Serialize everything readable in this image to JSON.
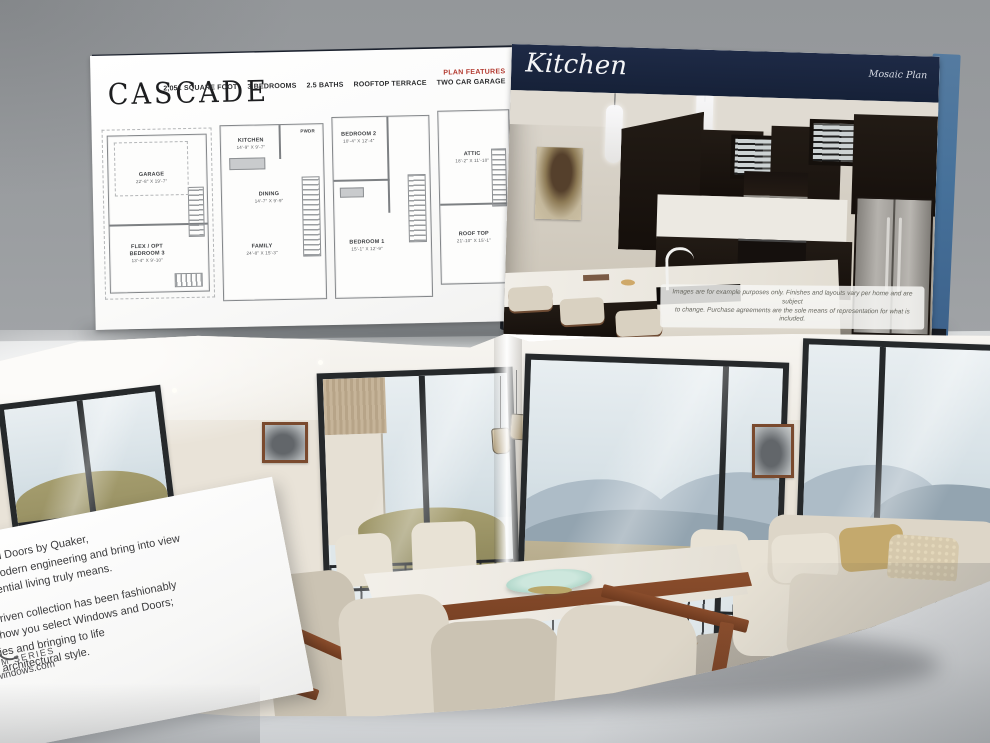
{
  "brochure_top": {
    "cascade_page": {
      "title": "CASCADE",
      "plan_features_label": "PLAN FEATURES",
      "stats": [
        "2,051 SQUARE FOOT",
        "3 BEDROOMS",
        "2.5 BATHS",
        "ROOFTOP TERRACE",
        "TWO CAR GARAGE"
      ],
      "floor_plans": {
        "main": {
          "garage_label": "GARAGE",
          "garage_dims": "22'-8\" X 19'-7\"",
          "flex_label": "FLEX / OPT BEDROOM 3",
          "flex_dims": "13'-4\" X 9'-10\""
        },
        "living": {
          "kitchen_label": "KITCHEN",
          "kitchen_dims": "14'-9\" X 9'-7\"",
          "pwdr_label": "PWDR",
          "dining_label": "DINING",
          "dining_dims": "14'-7\" X 9'-9\"",
          "family_label": "FAMILY",
          "family_dims": "24'-8\" X 15'-3\""
        },
        "bedroom": {
          "bed2_label": "BEDROOM 2",
          "bed2_dims": "10'-4\" X 12'-4\"",
          "bed1_label": "BEDROOM 1",
          "bed1_dims": "15'-1\" X 12'-9\""
        },
        "roof": {
          "attic_label": "ATTIC",
          "attic_dims": "18'-2\" X 11'-10\"",
          "rooftop_label": "ROOF TOP",
          "rooftop_dims": "21'-10\" X 15'-1\""
        }
      }
    },
    "kitchen_page": {
      "title": "Kitchen",
      "plan_name": "Mosaic Plan",
      "disclaimer_line1": "Images are for example purposes only. Finishes and layouts vary per home and are subject",
      "disclaimer_line2": "to change. Purchase agreements are the sole means of representation for what is included."
    }
  },
  "insert_card": {
    "para1_line1": "ndows and Doors by Quaker,",
    "para1_line2": "aries of modern engineering and bring into view",
    "para1_line3": "hat residential living truly means.",
    "para2_line1": "signer-driven collection has been fashionably",
    "para2_line2": "on into how you select Windows and Doors;",
    "para2_line3": "hnologies and bringing to life",
    "para2_line4": "nt any architectural style.",
    "series_fragment": "UM SERIES",
    "website_fragment": "windows.com"
  },
  "colors": {
    "header_navy": "#18233c",
    "accent_red": "#b2382e",
    "cover_blue": "#4d7296",
    "wall_gray": "#9a9da0"
  }
}
